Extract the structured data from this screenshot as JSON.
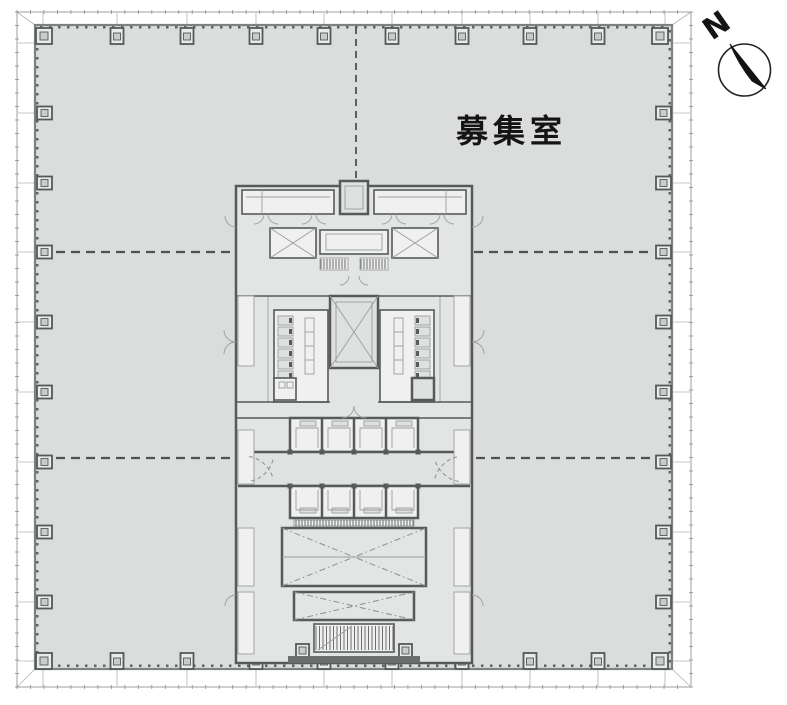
{
  "plan": {
    "vacancy_label": "募集室",
    "colors": {
      "background": "#ffffff",
      "slab_fill": "#dbdddc",
      "wall": "#565a59",
      "room_fill": "#eff0ef",
      "dash_line": "#4e5251",
      "compass": "#141414"
    }
  },
  "compass": {
    "north_letter": "N"
  }
}
